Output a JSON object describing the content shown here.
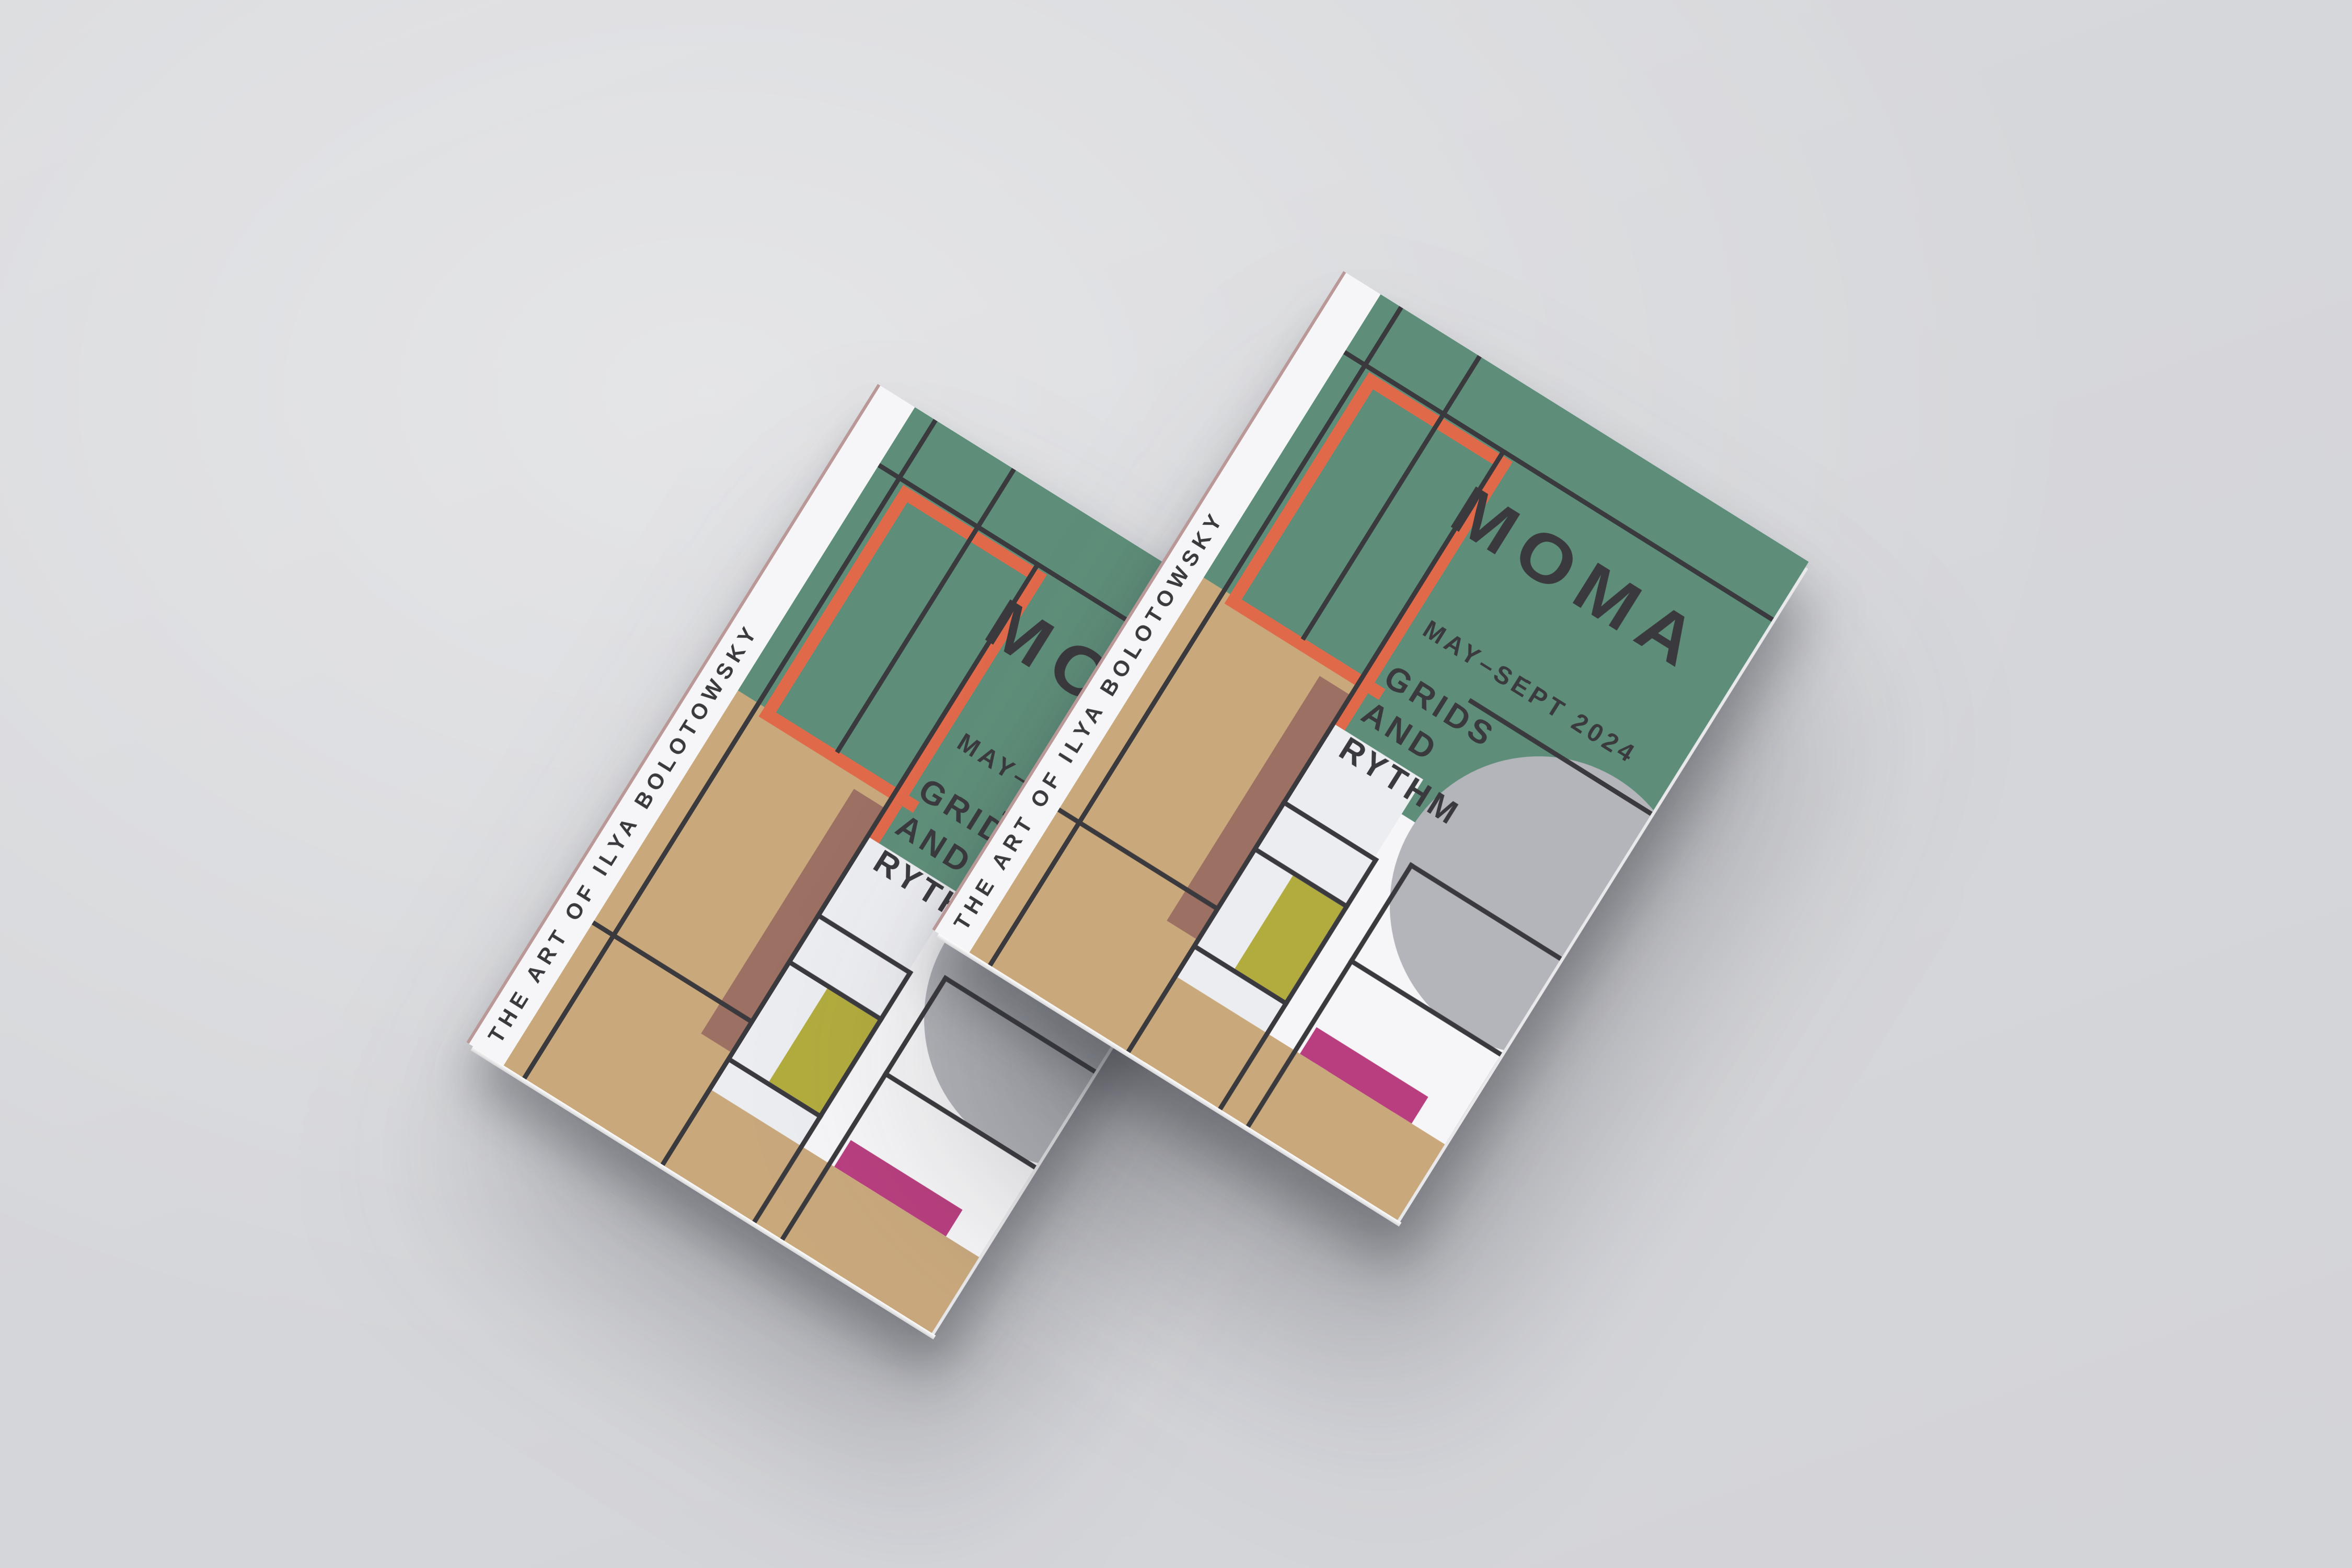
{
  "scene": {
    "description": "Two stacked exhibition brochures on a light gray surface",
    "brochure_count": 2
  },
  "brochure": {
    "spine_title": "THE ART OF ILYA BOLOTOWSKY",
    "museum": "MOMA",
    "dates": "MAY–SEPT 2024",
    "title_lines": {
      "0": "GRIDS",
      "1": "AND",
      "2": "RYTHM"
    },
    "palette": {
      "background": "#D8D9DC",
      "cover_white": "#F6F6F8",
      "cell_white": "#ECEDF0",
      "green": "#5E8E79",
      "orange": "#E0694A",
      "tan": "#C9A87C",
      "brown": "#9C7063",
      "olive": "#B2AB3D",
      "pink": "#B83E7F",
      "gray_circle": "#B3B5BA",
      "line": "#3A393D"
    }
  }
}
